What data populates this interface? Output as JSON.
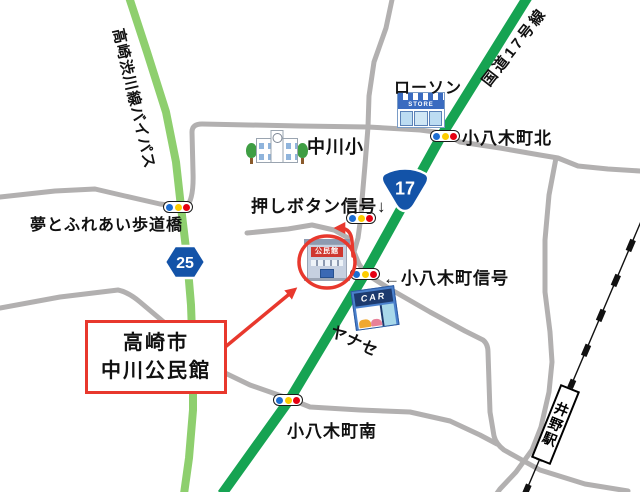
{
  "colors": {
    "route_green": "#16a352",
    "bypass_green": "#8ecf6e",
    "road_gray": "#b2b0b0",
    "accent_red": "#e8382d",
    "badge_blue": "#1353a8",
    "signal_blue": "#1c6dd2",
    "signal_yellow": "#fdcc00",
    "signal_red": "#e60012"
  },
  "destination_box": {
    "line1": "高崎市",
    "line2": "中川公民館"
  },
  "roads": {
    "bypass_label": "高崎渋川線バイパス",
    "route17_label": "国道17号線",
    "route17_badge": "17",
    "route25_badge": "25"
  },
  "signals": {
    "bridge": "夢とふれあい歩道橋",
    "north": "小八木町北",
    "push_button": "押しボタン信号↓",
    "main": "←小八木町信号",
    "south": "小八木町南"
  },
  "pois": {
    "lawson": {
      "label": "ローソン",
      "sign": "STORE"
    },
    "school": {
      "label": "中川小"
    },
    "community_center": {
      "sign": "公民館"
    },
    "car_dealer": {
      "label": "ヤナセ",
      "sign": "CAR"
    }
  },
  "station": {
    "name": "井野駅"
  }
}
